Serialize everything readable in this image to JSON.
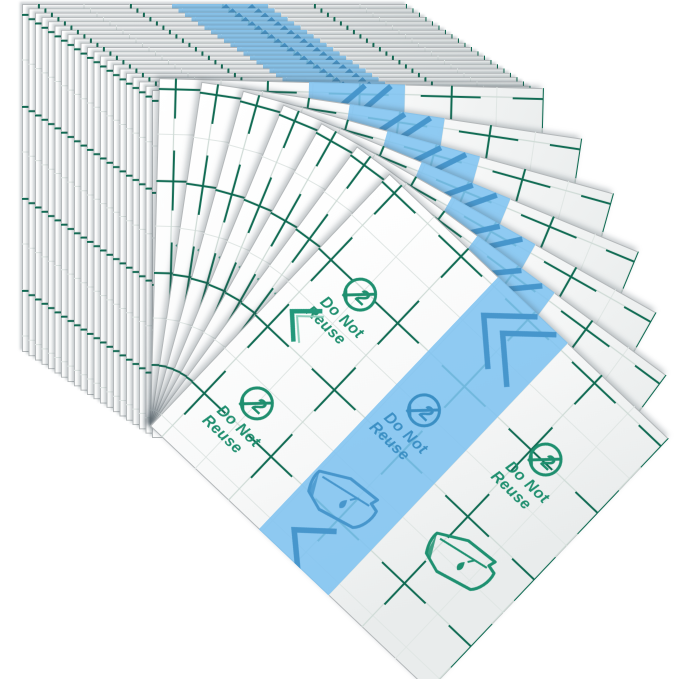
{
  "product_photo": {
    "subject": "stack of transparent film adhesive dressing sheets fanned out",
    "background": "#ffffff"
  },
  "labels": {
    "do_not": "Do Not",
    "reuse": "Reuse",
    "single_use_number": "2"
  },
  "colors": {
    "grid_green": "#0e6a52",
    "print_green": "#1f8f6f",
    "chevron_teal": "#23987b",
    "chevron_echo": "#8fd0bd",
    "stripe_blue": "#7fc3f0",
    "stripe_print_blue": "#4796cc",
    "stripe_mark_blue": "#3b8fc4",
    "sheet_edge": "#b4b8ba",
    "fine_line": "#d4dfdb",
    "background": "#ffffff"
  },
  "icons": [
    "do-not-reuse-icon",
    "film-peel-icon",
    "water-drop-icon",
    "chevron-icon",
    "grid-pattern",
    "blue-stripe"
  ],
  "scene": {
    "width": 679,
    "height": 679,
    "sheet": {
      "width": 385,
      "height": 348,
      "grid_spacing": 92
    },
    "stack": {
      "count": 21,
      "origin_x": 22,
      "origin_y": 4,
      "step_x": 6.5,
      "step_y": 4.3
    },
    "fan": {
      "count": 7,
      "pivot_x": 150,
      "pivot_y": 426,
      "start_angle_deg": 1.5,
      "step_angle_deg": 7
    }
  }
}
